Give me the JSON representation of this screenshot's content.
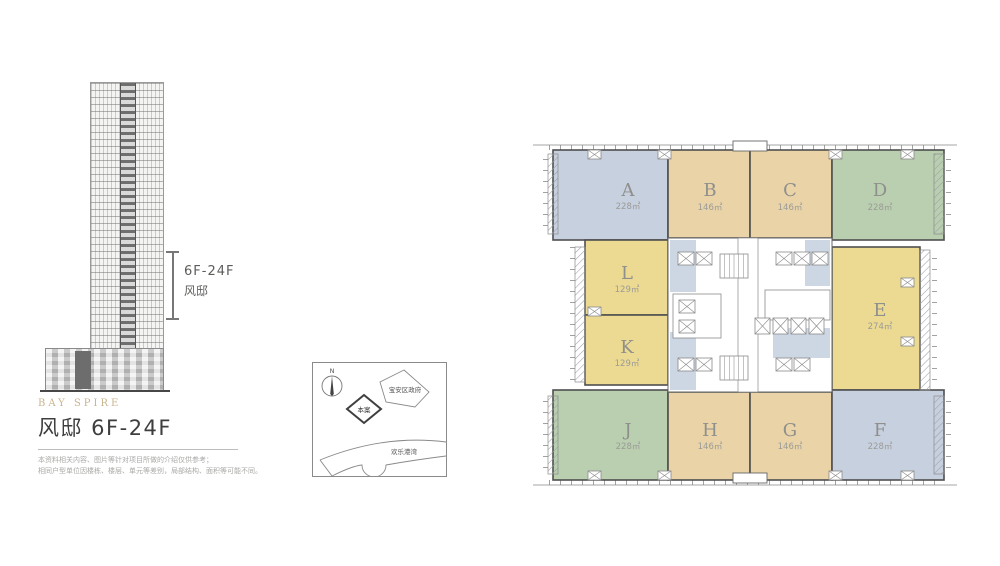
{
  "elevation": {
    "bracket_label_line1": "6F-24F",
    "bracket_label_line2": "风邸"
  },
  "title_block": {
    "brand": "BAY SPIRE",
    "title": "风邸 6F-24F",
    "disclaimer_line1": "本资料相关内容、图片等针对项目所做的介绍仅供参考；",
    "disclaimer_line2": "相同户型单位因楼栋、楼层、单元等差别，局部结构、面积等可能不同。"
  },
  "map": {
    "north_label": "N",
    "landmark_government": "宝安区政府",
    "landmark_site": "本案",
    "landmark_bay": "欢乐港湾"
  },
  "plan": {
    "wall_color": "#4f4f4f",
    "corridor_color": "#cdd6e3",
    "letter_color": "#8f8f8c",
    "area_color": "#9b9b97",
    "units": [
      {
        "letter": "A",
        "area": "228㎡",
        "color": "#c7d0df"
      },
      {
        "letter": "B",
        "area": "146㎡",
        "color": "#e9d3a7"
      },
      {
        "letter": "C",
        "area": "146㎡",
        "color": "#e9d3a7"
      },
      {
        "letter": "D",
        "area": "228㎡",
        "color": "#b9cfb0"
      },
      {
        "letter": "E",
        "area": "274㎡",
        "color": "#ecda92"
      },
      {
        "letter": "F",
        "area": "228㎡",
        "color": "#c7d0df"
      },
      {
        "letter": "G",
        "area": "146㎡",
        "color": "#e9d3a7"
      },
      {
        "letter": "H",
        "area": "146㎡",
        "color": "#e9d3a7"
      },
      {
        "letter": "J",
        "area": "228㎡",
        "color": "#b9cfb0"
      },
      {
        "letter": "K",
        "area": "129㎡",
        "color": "#ecda92"
      },
      {
        "letter": "L",
        "area": "129㎡",
        "color": "#ecda92"
      }
    ]
  }
}
